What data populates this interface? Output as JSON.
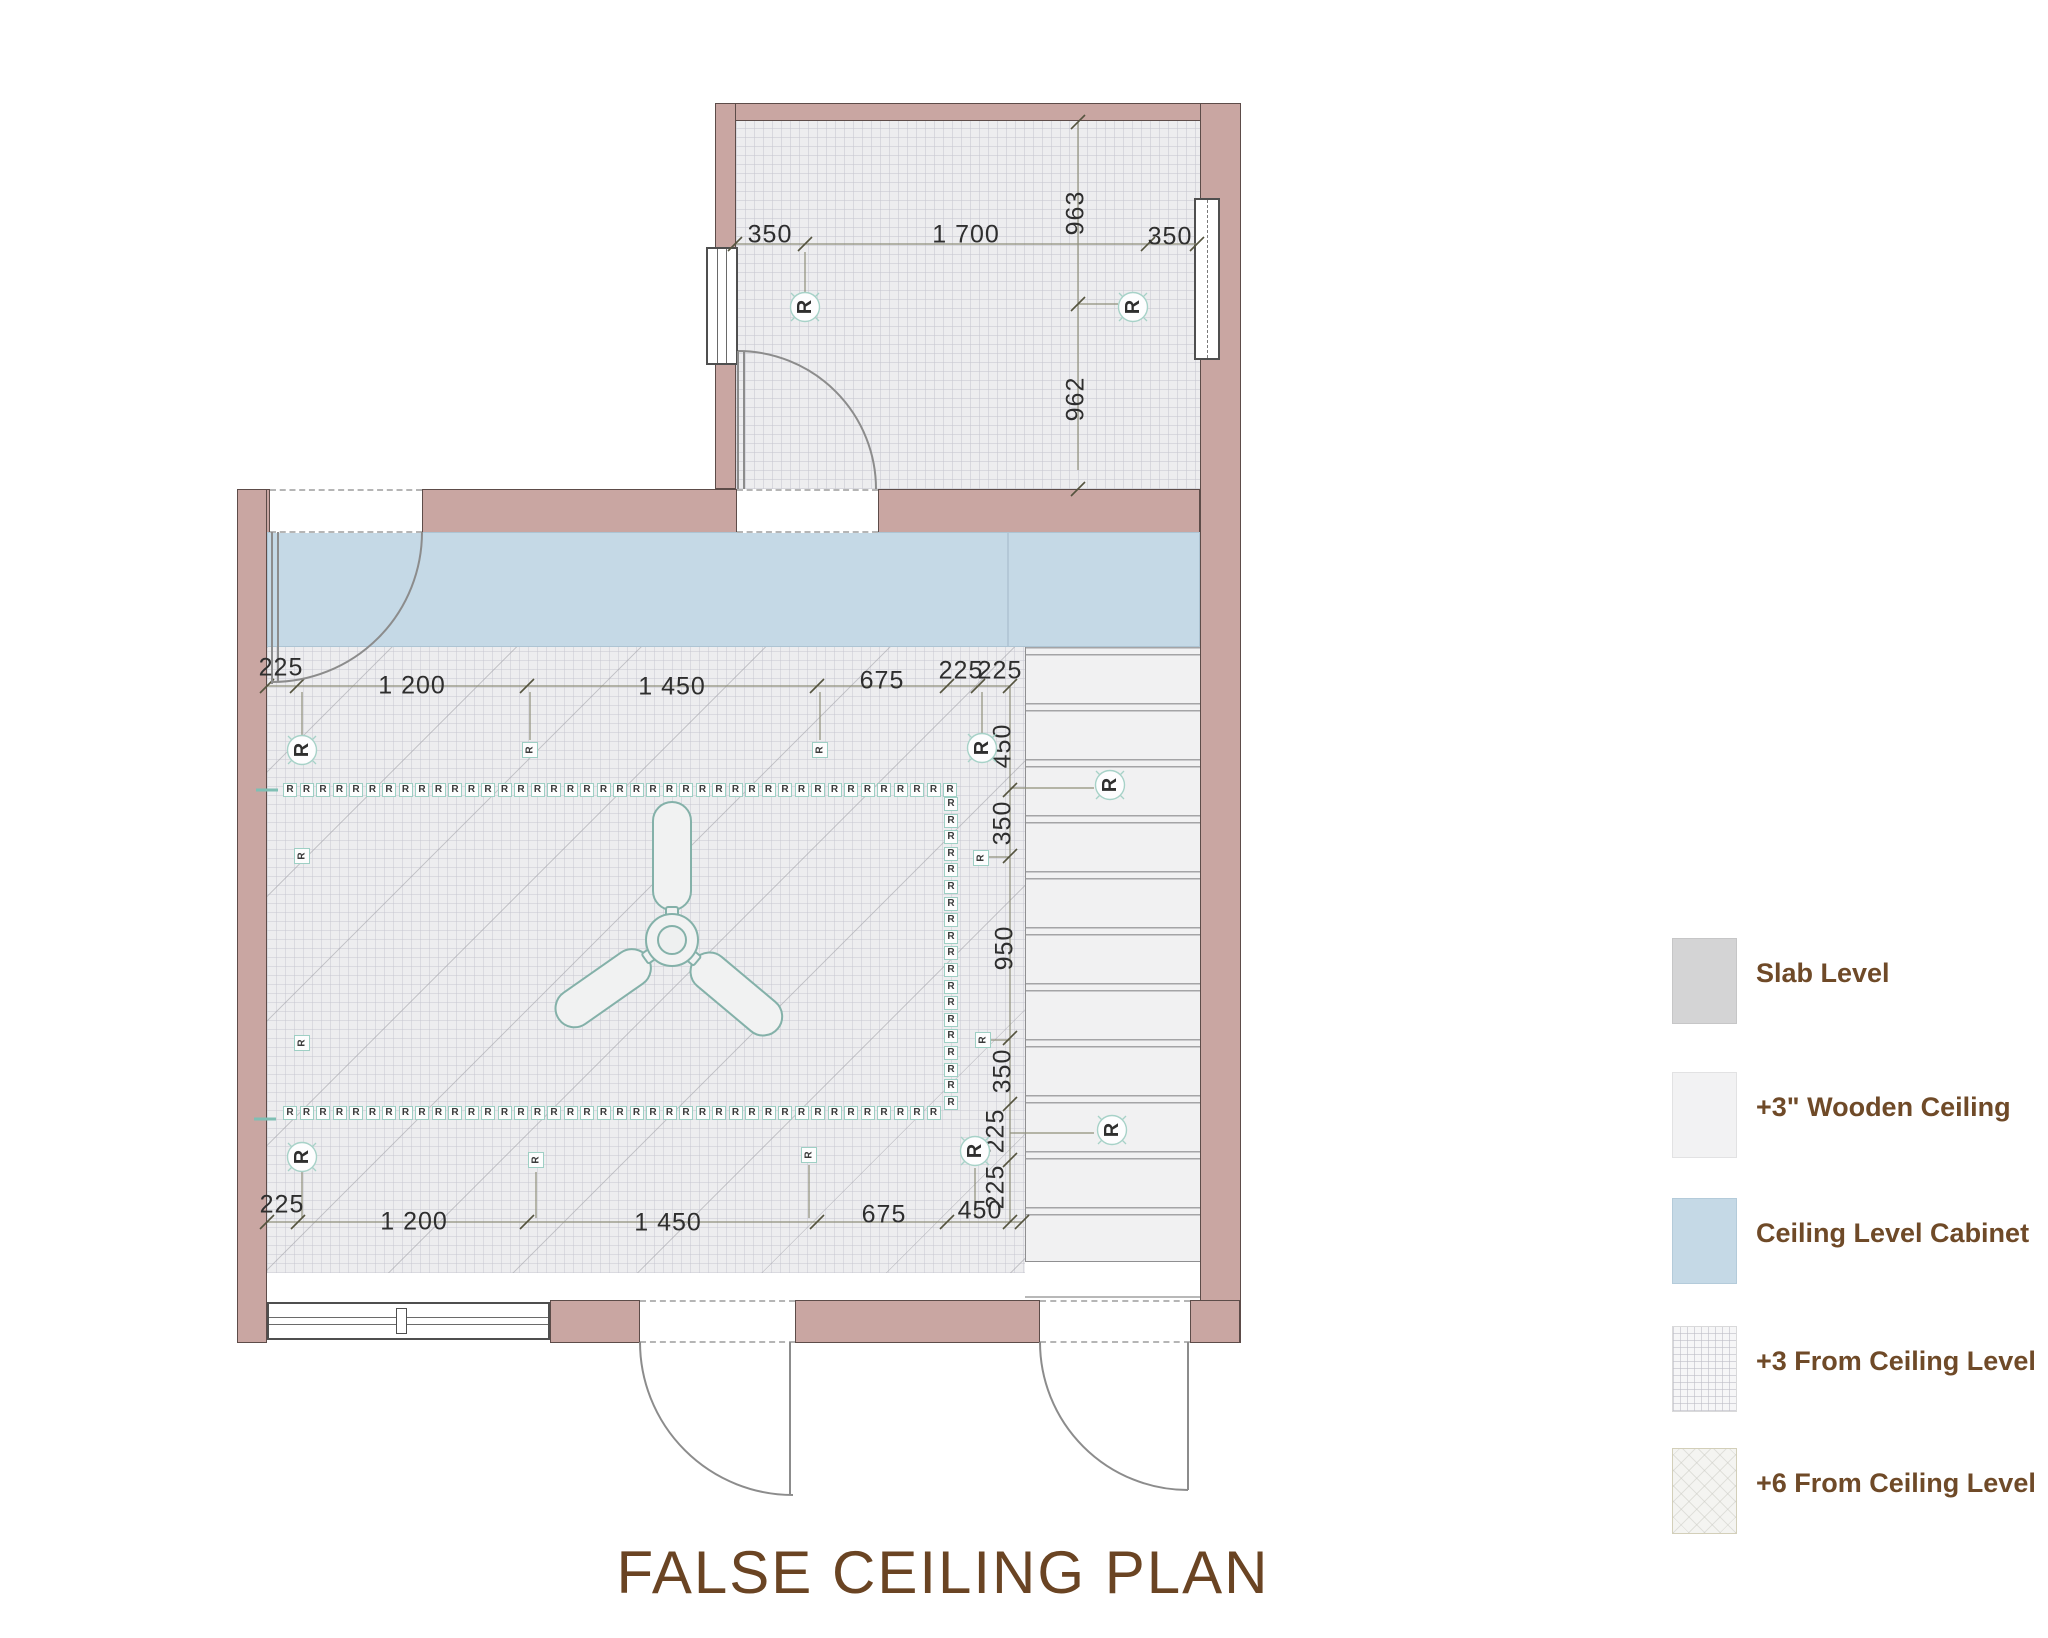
{
  "title": "FALSE CEILING PLAN",
  "marker_letter": "R",
  "colors": {
    "wall": "#c9a6a2",
    "cabinet_blue": "#c5d9e6",
    "label_brown": "#6f4a28",
    "marker_teal": "#9ecfc4",
    "slab_gray": "#d4d4d5"
  },
  "legend": {
    "items": [
      {
        "label": "Slab Level",
        "swatch": "slab"
      },
      {
        "label": "+3\"  Wooden Ceiling",
        "swatch": "wood"
      },
      {
        "label": "Ceiling Level Cabinet",
        "swatch": "cabinet"
      },
      {
        "label": "+3 From Ceiling Level",
        "swatch": "plus3"
      },
      {
        "label": "+6 From Ceiling Level",
        "swatch": "plus6"
      }
    ],
    "tops": [
      938,
      1072,
      1198,
      1326,
      1448
    ]
  },
  "dim_labels": [
    {
      "t": "350",
      "x": 770,
      "y": 235,
      "r": 0
    },
    {
      "t": "1 700",
      "x": 966,
      "y": 235,
      "r": 0
    },
    {
      "t": "350",
      "x": 1170,
      "y": 237,
      "r": 0
    },
    {
      "t": "963",
      "x": 1076,
      "y": 213,
      "r": 1
    },
    {
      "t": "962",
      "x": 1076,
      "y": 399,
      "r": 1
    },
    {
      "t": "225",
      "x": 281,
      "y": 668,
      "r": 0
    },
    {
      "t": "1 200",
      "x": 412,
      "y": 686,
      "r": 0
    },
    {
      "t": "1 450",
      "x": 672,
      "y": 687,
      "r": 0
    },
    {
      "t": "675",
      "x": 882,
      "y": 681,
      "r": 0
    },
    {
      "t": "225",
      "x": 961,
      "y": 671,
      "r": 0
    },
    {
      "t": "225",
      "x": 1000,
      "y": 671,
      "r": 0
    },
    {
      "t": "450",
      "x": 1003,
      "y": 746,
      "r": 1
    },
    {
      "t": "350",
      "x": 1003,
      "y": 823,
      "r": 1
    },
    {
      "t": "950",
      "x": 1005,
      "y": 948,
      "r": 1
    },
    {
      "t": "350",
      "x": 1003,
      "y": 1071,
      "r": 1
    },
    {
      "t": "225",
      "x": 996,
      "y": 1131,
      "r": 1
    },
    {
      "t": "225",
      "x": 996,
      "y": 1187,
      "r": 1
    },
    {
      "t": "225",
      "x": 282,
      "y": 1205,
      "r": 0
    },
    {
      "t": "1 200",
      "x": 414,
      "y": 1222,
      "r": 0
    },
    {
      "t": "1 450",
      "x": 668,
      "y": 1223,
      "r": 0
    },
    {
      "t": "675",
      "x": 884,
      "y": 1215,
      "r": 0
    },
    {
      "t": "450",
      "x": 980,
      "y": 1211,
      "r": 0
    }
  ],
  "markers": {
    "big": [
      [
        805,
        307
      ],
      [
        1133,
        307
      ],
      [
        302,
        750
      ],
      [
        982,
        748
      ],
      [
        1110,
        785
      ],
      [
        1112,
        1130
      ],
      [
        302,
        1157
      ],
      [
        975,
        1151
      ]
    ],
    "small": [
      [
        530,
        750
      ],
      [
        820,
        750
      ],
      [
        302,
        856
      ],
      [
        981,
        858
      ],
      [
        302,
        1043
      ],
      [
        983,
        1040
      ],
      [
        536,
        1160
      ],
      [
        809,
        1155
      ]
    ]
  },
  "strips": {
    "horizontal": [
      {
        "x": 283,
        "y": 783,
        "count": 41,
        "step": 16.5
      },
      {
        "x": 283,
        "y": 1106,
        "count": 40,
        "step": 16.5
      }
    ],
    "vertical": [
      {
        "x": 944,
        "y": 797,
        "count": 19,
        "step": 16.6
      }
    ]
  }
}
